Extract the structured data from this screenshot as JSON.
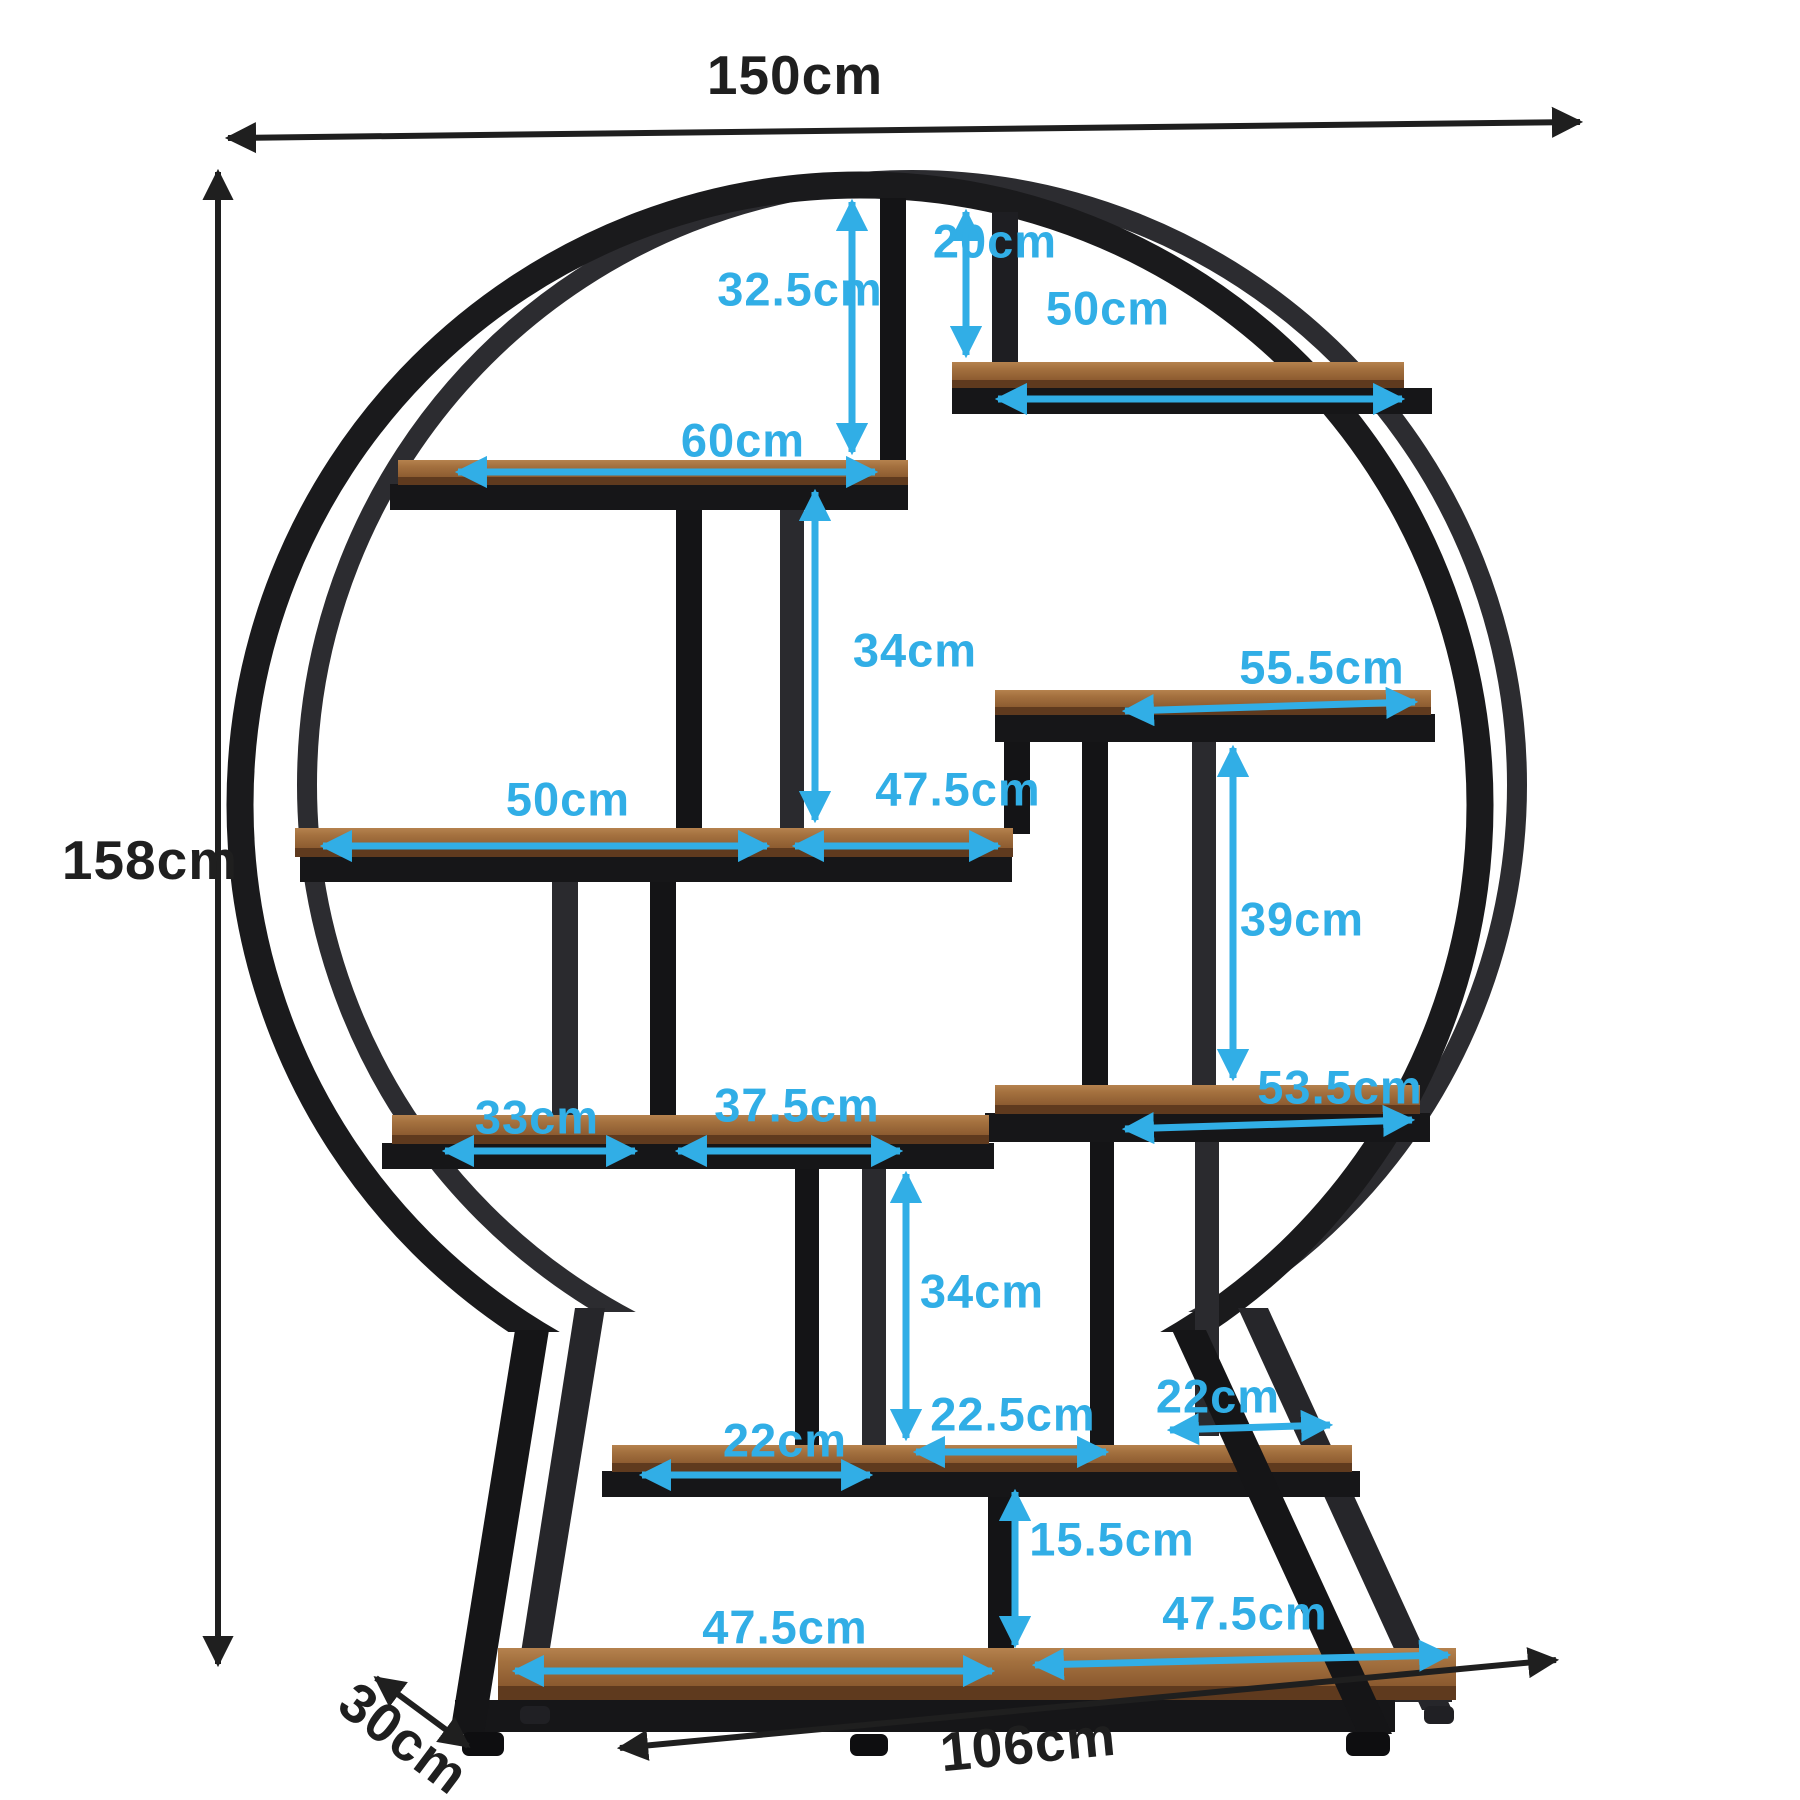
{
  "diagram": {
    "type": "product-dimension-diagram",
    "subject": "round industrial etagere bookshelf with wooden shelves and black metal circular frame",
    "units": "cm",
    "colors": {
      "accent": "#31aee6",
      "frame": "#1a1a1c",
      "frame_back": "#2c2c30",
      "wood_light": "#a4713f",
      "wood_dark": "#7c4c26",
      "dim_text": "#1f1f1f"
    },
    "dimensions": {
      "total_width": "150cm",
      "total_height": "158cm",
      "depth": "30cm",
      "base_width": "106cm",
      "top_gap_left": "32.5cm",
      "top_gap_right": "20cm",
      "shelf_top_right": "50cm",
      "shelf_upper_left": "60cm",
      "gap_upper_middle": "34cm",
      "shelf_mid_right": "55.5cm",
      "shelf_middle_left": "50cm",
      "shelf_middle_right_segment": "47.5cm",
      "gap_right_column": "39cm",
      "shelf_lower_right": "53.5cm",
      "segment_lower_left": "33cm",
      "segment_lower_middle": "37.5cm",
      "gap_lower_middle": "34cm",
      "segment_shelf2_left": "22cm",
      "segment_shelf2_middle": "22.5cm",
      "segment_shelf2_right": "22cm",
      "gap_bottom": "15.5cm",
      "segment_bottom_left": "47.5cm",
      "segment_bottom_right": "47.5cm"
    }
  }
}
